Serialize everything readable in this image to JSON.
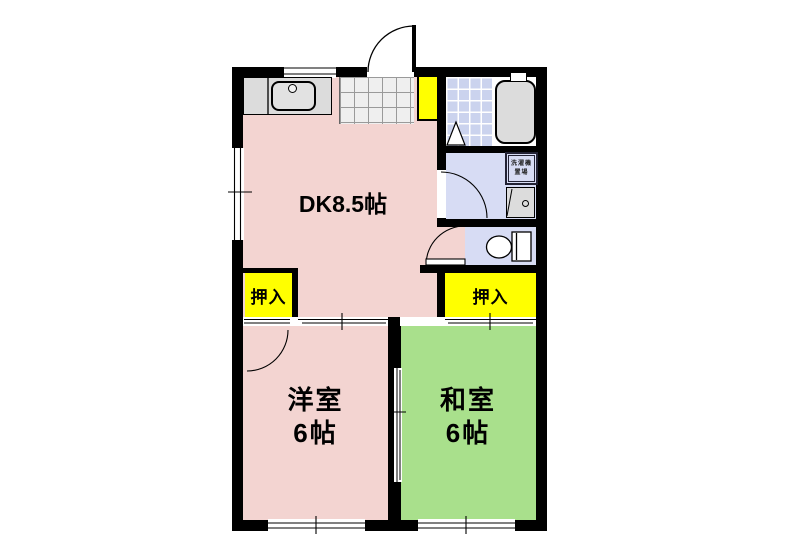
{
  "floorplan": {
    "rooms": {
      "dk": {
        "label": "DK8.5帖"
      },
      "western": {
        "name": "洋室",
        "size": "6帖"
      },
      "japanese": {
        "name": "和室",
        "size": "6帖"
      },
      "closet_left": {
        "label": "押入"
      },
      "closet_right": {
        "label": "押入"
      },
      "laundry": {
        "line1": "洗濯機",
        "line2": "置場"
      }
    },
    "colors": {
      "dk_pink": "#F3D4D1",
      "tatami_green": "#A9E08C",
      "closet_yellow": "#FFFF00",
      "wet_lavender": "#D7DCF4",
      "bath_tile": "#CBD3EE",
      "fixture_gray": "#DCDCDC",
      "wall_black": "#000000"
    }
  }
}
